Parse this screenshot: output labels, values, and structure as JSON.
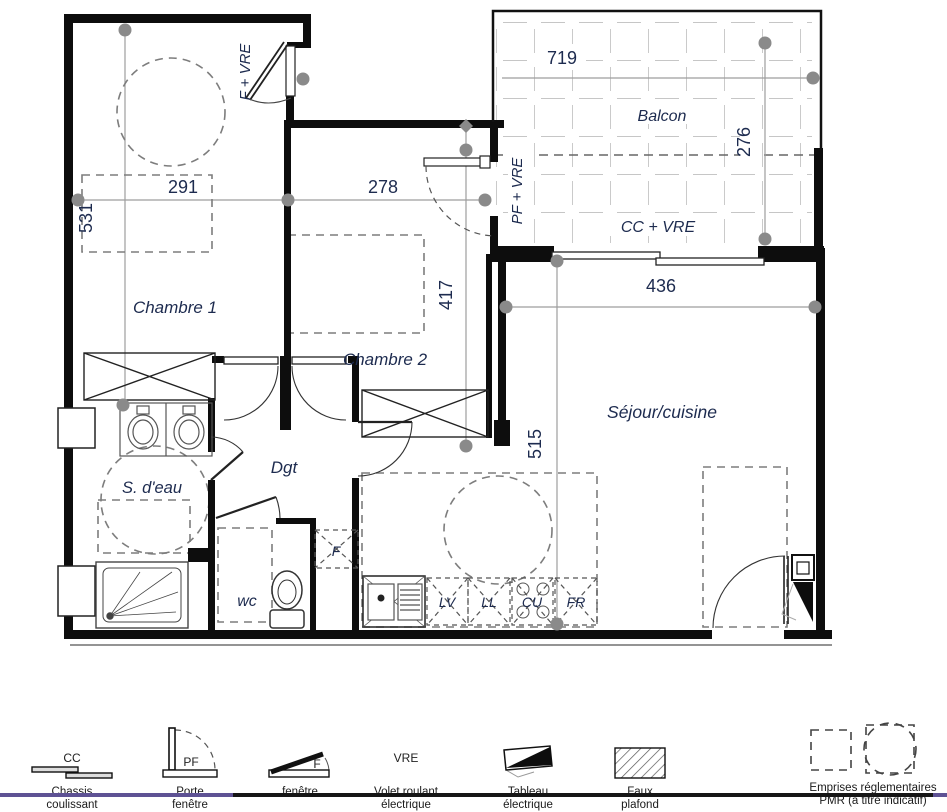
{
  "plan": {
    "rooms": {
      "chambre1": "Chambre 1",
      "chambre2": "Chambre 2",
      "sejour": "Séjour/cuisine",
      "sdeau": "S. d'eau",
      "dgt": "Dgt",
      "wc": "wc",
      "balcon": "Balcon"
    },
    "dimensions": {
      "chambre1_w": "291",
      "chambre1_h": "531",
      "chambre2_w": "278",
      "chambre2_h": "417",
      "balcon_w": "719",
      "balcon_h": "276",
      "sejour_w": "436",
      "sejour_h": "515"
    },
    "openings": {
      "window_chambre1": "F + VRE",
      "door_balcon": "PF + VRE",
      "slider_sejour": "CC + VRE"
    },
    "appliances": {
      "lv": "LV",
      "ll": "LL",
      "cu": "CU",
      "fr": "FR",
      "f": "F"
    }
  },
  "legend": {
    "items": [
      {
        "code": "CC",
        "line1": "Chassis",
        "line2": "coulissant"
      },
      {
        "code": "PF",
        "line1": "Porte",
        "line2": "fenêtre"
      },
      {
        "code": "F",
        "line1": "fenêtre",
        "line2": ""
      },
      {
        "code": "VRE",
        "line1": "Volet roulant",
        "line2": "électrique"
      },
      {
        "code": "",
        "line1": "Tableau",
        "line2": "électrique"
      },
      {
        "code": "",
        "line1": "Faux",
        "line2": "plafond"
      },
      {
        "code": "",
        "line1": "Emprises réglementaires",
        "line2": "PMR (à titre indicatif)"
      }
    ]
  },
  "colors": {
    "label": "#1d2b4f",
    "wall": "#0d0d0d",
    "dim_line": "#9e9e9e",
    "marker": "#8a8a8a",
    "accent_purple": "#5e5294",
    "bar_dark": "#161616"
  }
}
